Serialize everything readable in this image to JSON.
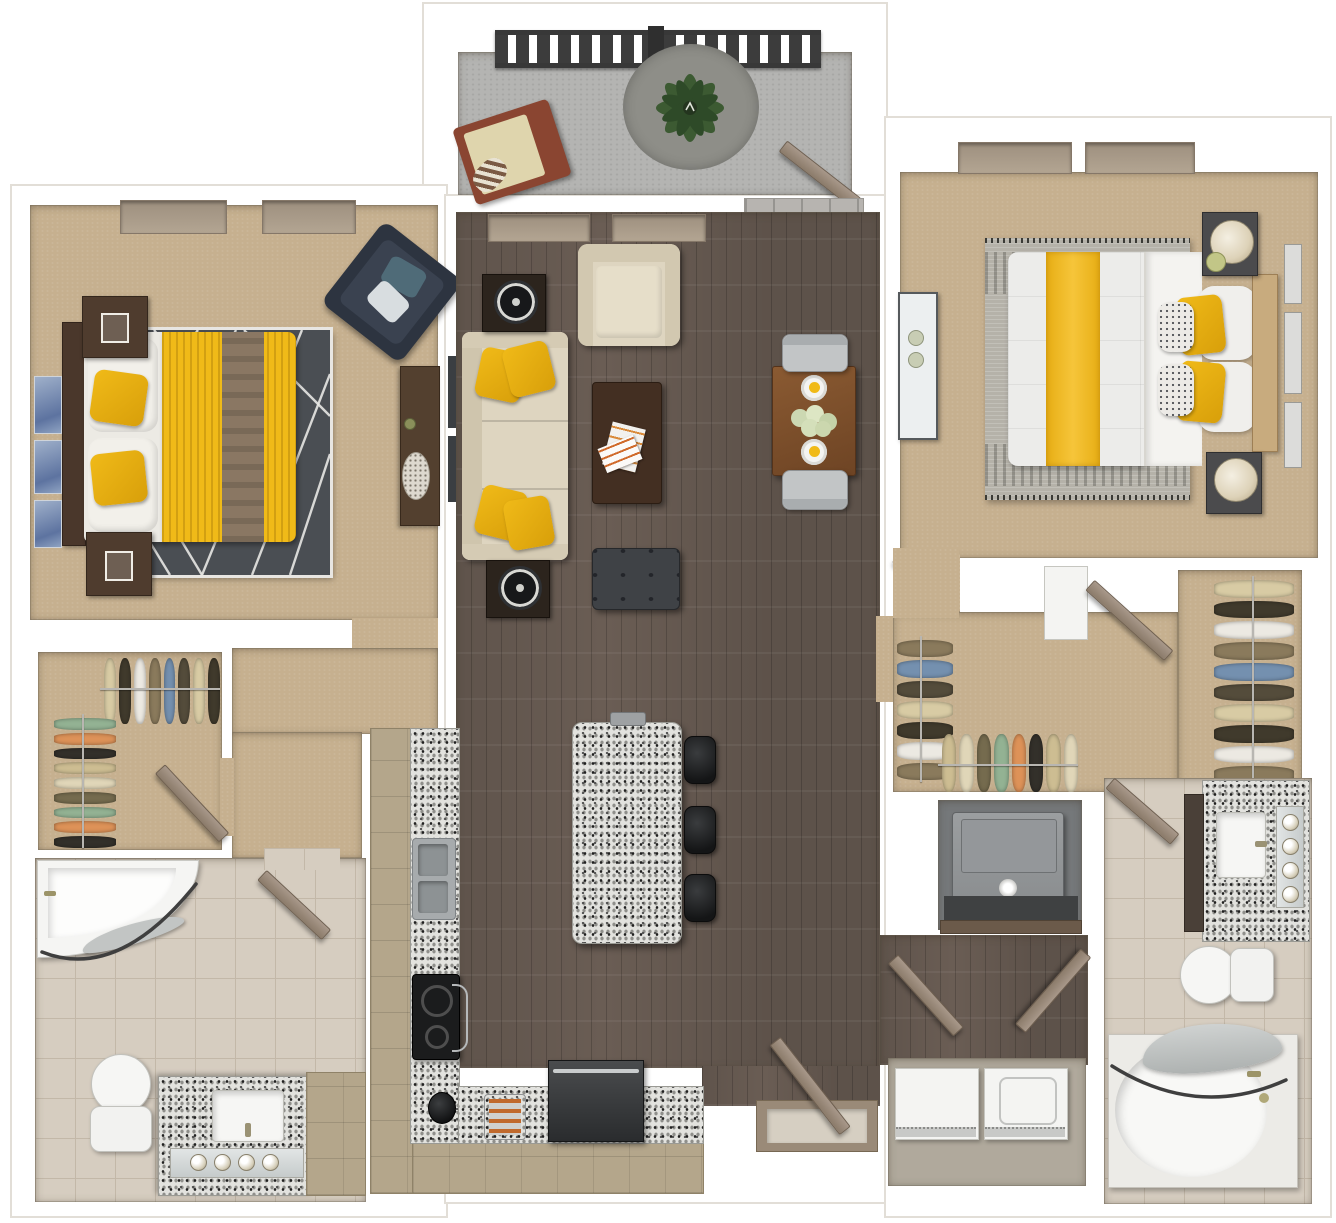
{
  "scene": {
    "type": "3d-floor-plan-render",
    "view": "top-down",
    "unit": {
      "bedrooms": 2,
      "bathrooms": 2,
      "rooms": [
        "balcony",
        "bedroom-1",
        "walk-in-closet-1",
        "bathroom-1",
        "living-room",
        "dining-area",
        "kitchen",
        "entry",
        "hallway",
        "walk-in-closet-2",
        "linen-closet",
        "mechanical-closet",
        "laundry-closet",
        "bedroom-2",
        "bathroom-2"
      ]
    },
    "furniture": {
      "balcony": [
        "railing",
        "round-rug",
        "potted-plant",
        "lounge-chair",
        "open-door"
      ],
      "bedroom_1": [
        "bed-yellow-duvet",
        "2-yellow-pillows",
        "2-nightstands",
        "2-table-lamps",
        "geometric-rug",
        "navy-armchair",
        "dresser",
        "3-wall-art-panels",
        "2-window-insets"
      ],
      "living_room": [
        "cream-sofa",
        "4-yellow-throw-pillows",
        "2-end-tables",
        "2-round-speakers",
        "cream-armchair",
        "coffee-table",
        "magazines",
        "gray-ottoman",
        "tv-wall-strips"
      ],
      "dining_area": [
        "wood-table",
        "2-gray-chairs",
        "2-place-settings",
        "flower-centerpiece"
      ],
      "kitchen": [
        "l-shaped-granite-counter",
        "double-sink",
        "cooktop",
        "kettle",
        "toaster",
        "refrigerator",
        "granite-island",
        "3-bar-stools"
      ],
      "bathroom_1": [
        "corner-tub",
        "shower-rod",
        "shower-curtain",
        "toilet",
        "granite-vanity",
        "sink",
        "mirror",
        "4-vanity-lights",
        "wood-cabinet"
      ],
      "bathroom_2": [
        "oval-tub",
        "shower-rod",
        "shower-curtain",
        "toilet",
        "granite-vanity",
        "sink",
        "mirror",
        "4-vanity-lights",
        "dark-cabinets"
      ],
      "bedroom_2": [
        "bed-white-duvet-yellow-runner",
        "2-yellow-pillows",
        "2-patterned-pillows",
        "2-nightstands",
        "2-round-lamps",
        "woven-fringe-rug",
        "white-dresser",
        "3-picture-frames",
        "2-window-insets"
      ],
      "closets": [
        "hanging-clothes-racks"
      ],
      "laundry_closet": [
        "washer",
        "dryer",
        "double-doors"
      ],
      "mechanical_closet": [
        "water-heater"
      ]
    },
    "counts": {
      "bar_stools": 3,
      "vanity_lights_per_bath": 4,
      "laundry_appliances": 2,
      "dining_chairs": 2
    }
  },
  "palette": {
    "wall": "#ffffff",
    "wall-edge": "#e2ded7",
    "carpet": "#c6b08f",
    "wood": "#6a5d54",
    "tile": "#d6cdc0",
    "tile-line": "#c3b8a8",
    "concrete": "#b4b4b2",
    "concrete-rug": "#8e8e88",
    "granite": "#e2e2de",
    "cabinet": "#b4a68b",
    "dark-wood": "#4c3929",
    "accent-yellow": "#f0ba18",
    "duvet-brown": "#8a7763",
    "cream": "#ded5c0",
    "navy": "#2d3440",
    "rug-dark": "#4a4e53",
    "rug-woven": "#b5b2a9",
    "steel": "#a7abad",
    "appliance-dark": "#333537",
    "door-wood": "#99897a",
    "plant-green": "#3c5a32",
    "curtain-gray": "#c2c5c4",
    "greige": "#d6cfc2"
  },
  "clothes_colors": [
    "#d8cba4",
    "#756b4e",
    "#403a2c",
    "#93b293",
    "#ece9e2",
    "#dd9258",
    "#8a7a5c",
    "#33302a",
    "#7490af",
    "#cdbd92",
    "#544c3b",
    "#e0d6b8"
  ]
}
